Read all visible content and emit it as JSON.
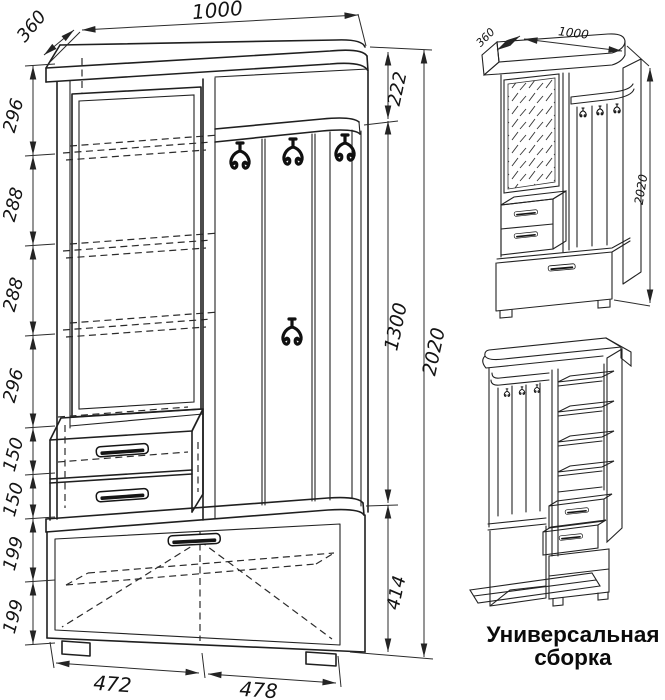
{
  "front_view": {
    "top_width": "1000",
    "depth": "360",
    "left_dims": [
      "296",
      "288",
      "288",
      "296",
      "150",
      "150",
      "199",
      "199"
    ],
    "right_dims": [
      "222",
      "1300",
      "414"
    ],
    "overall_height": "2020",
    "bottom_widths": [
      "472",
      "478"
    ]
  },
  "iso_view": {
    "depth": "360",
    "width": "1000",
    "height": "2020"
  },
  "caption": {
    "line1": "Универсальная",
    "line2": "сборка"
  }
}
